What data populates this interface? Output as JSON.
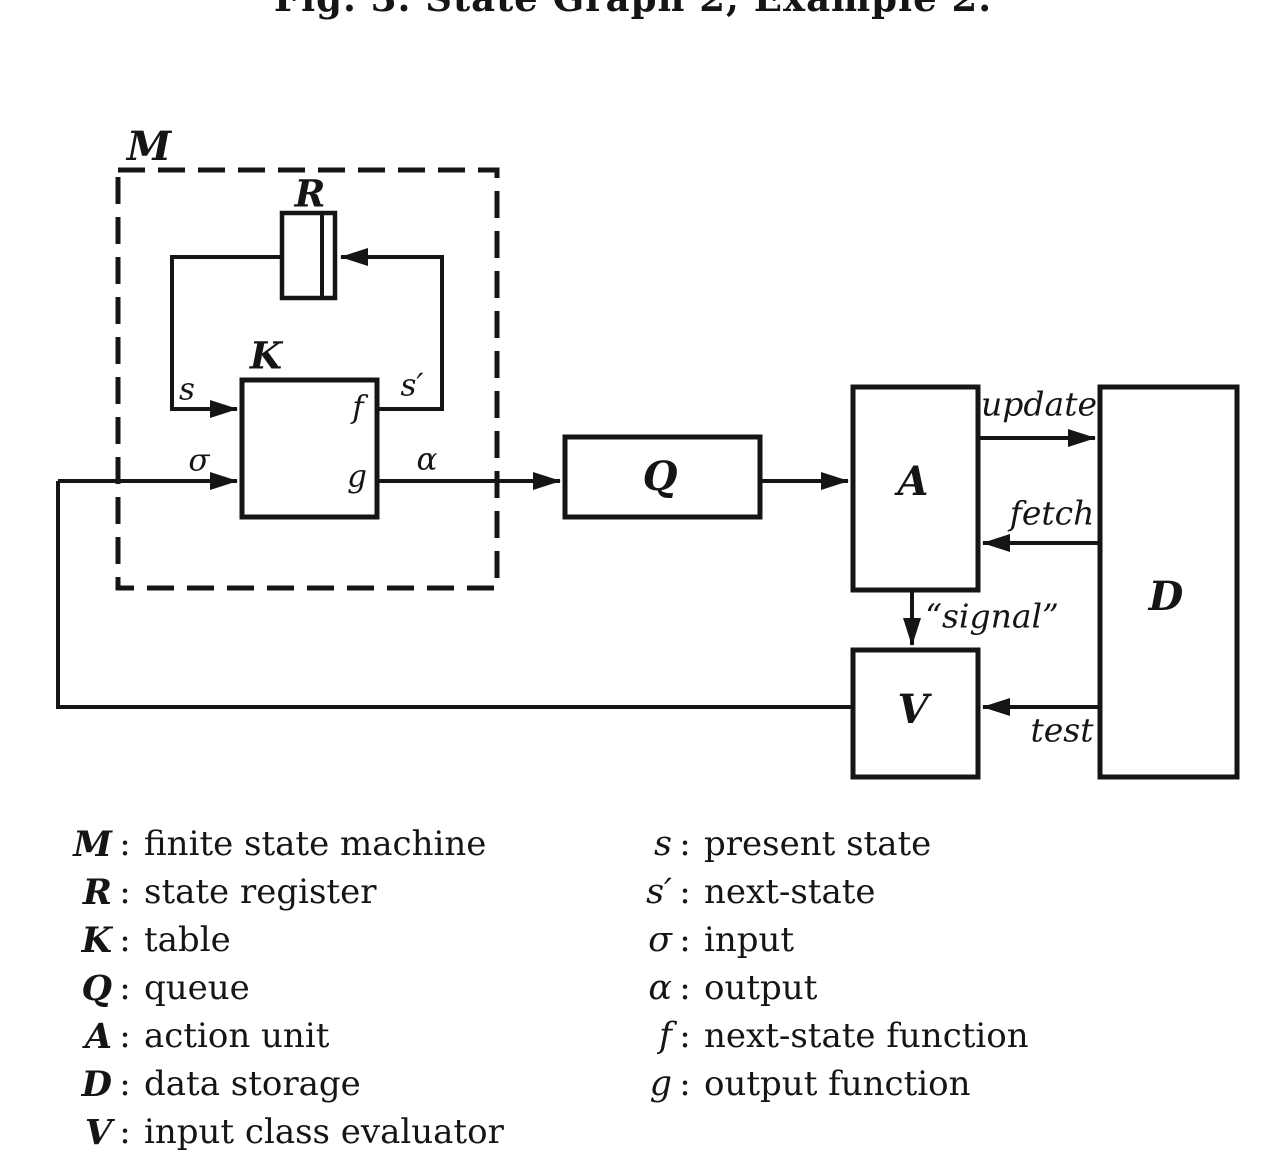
{
  "caption": {
    "text": "Fig. 3. State Graph 2, Example 2."
  },
  "diagram": {
    "blocks": {
      "m_label": "M",
      "r_label": "R",
      "k_label": "K",
      "q_label": "Q",
      "a_label": "A",
      "d_label": "D",
      "v_label": "V"
    },
    "signals": {
      "s": "s",
      "s_prime": "s′",
      "sigma": "σ",
      "alpha": "α",
      "f": "f",
      "g": "g",
      "update": "update",
      "fetch": "fetch",
      "signal": "“signal”",
      "test": "test"
    }
  },
  "legend": {
    "colon": ":",
    "left": [
      {
        "symbol": "M",
        "desc": "finite state machine"
      },
      {
        "symbol": "R",
        "desc": "state register"
      },
      {
        "symbol": "K",
        "desc": "table"
      },
      {
        "symbol": "Q",
        "desc": "queue"
      },
      {
        "symbol": "A",
        "desc": "action unit"
      },
      {
        "symbol": "D",
        "desc": "data storage"
      },
      {
        "symbol": "V",
        "desc": "input class evaluator"
      }
    ],
    "right": [
      {
        "symbol": "s",
        "desc": "present state"
      },
      {
        "symbol": "s′",
        "desc": "next-state"
      },
      {
        "symbol": "σ",
        "desc": "input"
      },
      {
        "symbol": "α",
        "desc": "output"
      },
      {
        "symbol": "f",
        "desc": "next-state function"
      },
      {
        "symbol": "g",
        "desc": "output function"
      }
    ]
  }
}
